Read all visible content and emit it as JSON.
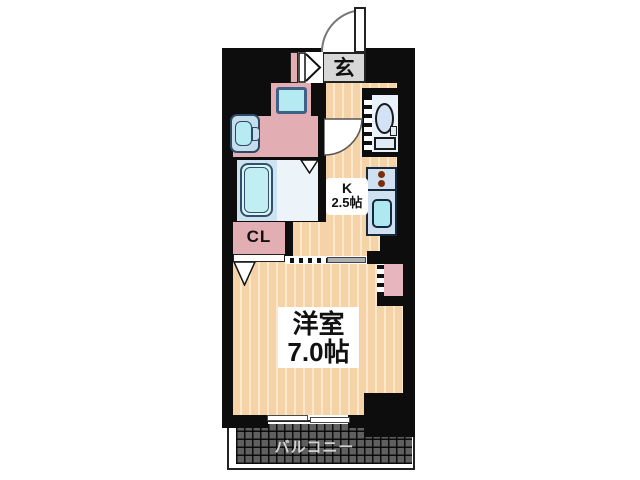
{
  "rooms": {
    "genkan": {
      "label": "玄"
    },
    "kitchen": {
      "label": "K",
      "size": "2.5帖"
    },
    "closet": {
      "label": "CL"
    },
    "western_room": {
      "label": "洋室",
      "size": "7.0帖"
    },
    "balcony": {
      "label": "バルコニー"
    }
  },
  "fixtures": [
    "entrance-swing-door",
    "folding-door",
    "washing-machine",
    "wash-basin",
    "bathtub",
    "toilet",
    "kitchen-counter",
    "stove-burners",
    "kitchen-sink",
    "refrigerator-space",
    "closet-door",
    "sliding-door",
    "window",
    "pillar"
  ],
  "colors": {
    "wall": "#0d0d0d",
    "floor": "#f6d2a7",
    "floor_stripe": "#fce8cd",
    "room_pink": "#e2aeb4",
    "genkan_gray": "#d7d7d7",
    "fixture_blue": "#cfe1f0",
    "sink_cyan": "#aee9f1",
    "balcony_gray": "#5f5f5f",
    "burner_red": "#7c2e0c"
  }
}
